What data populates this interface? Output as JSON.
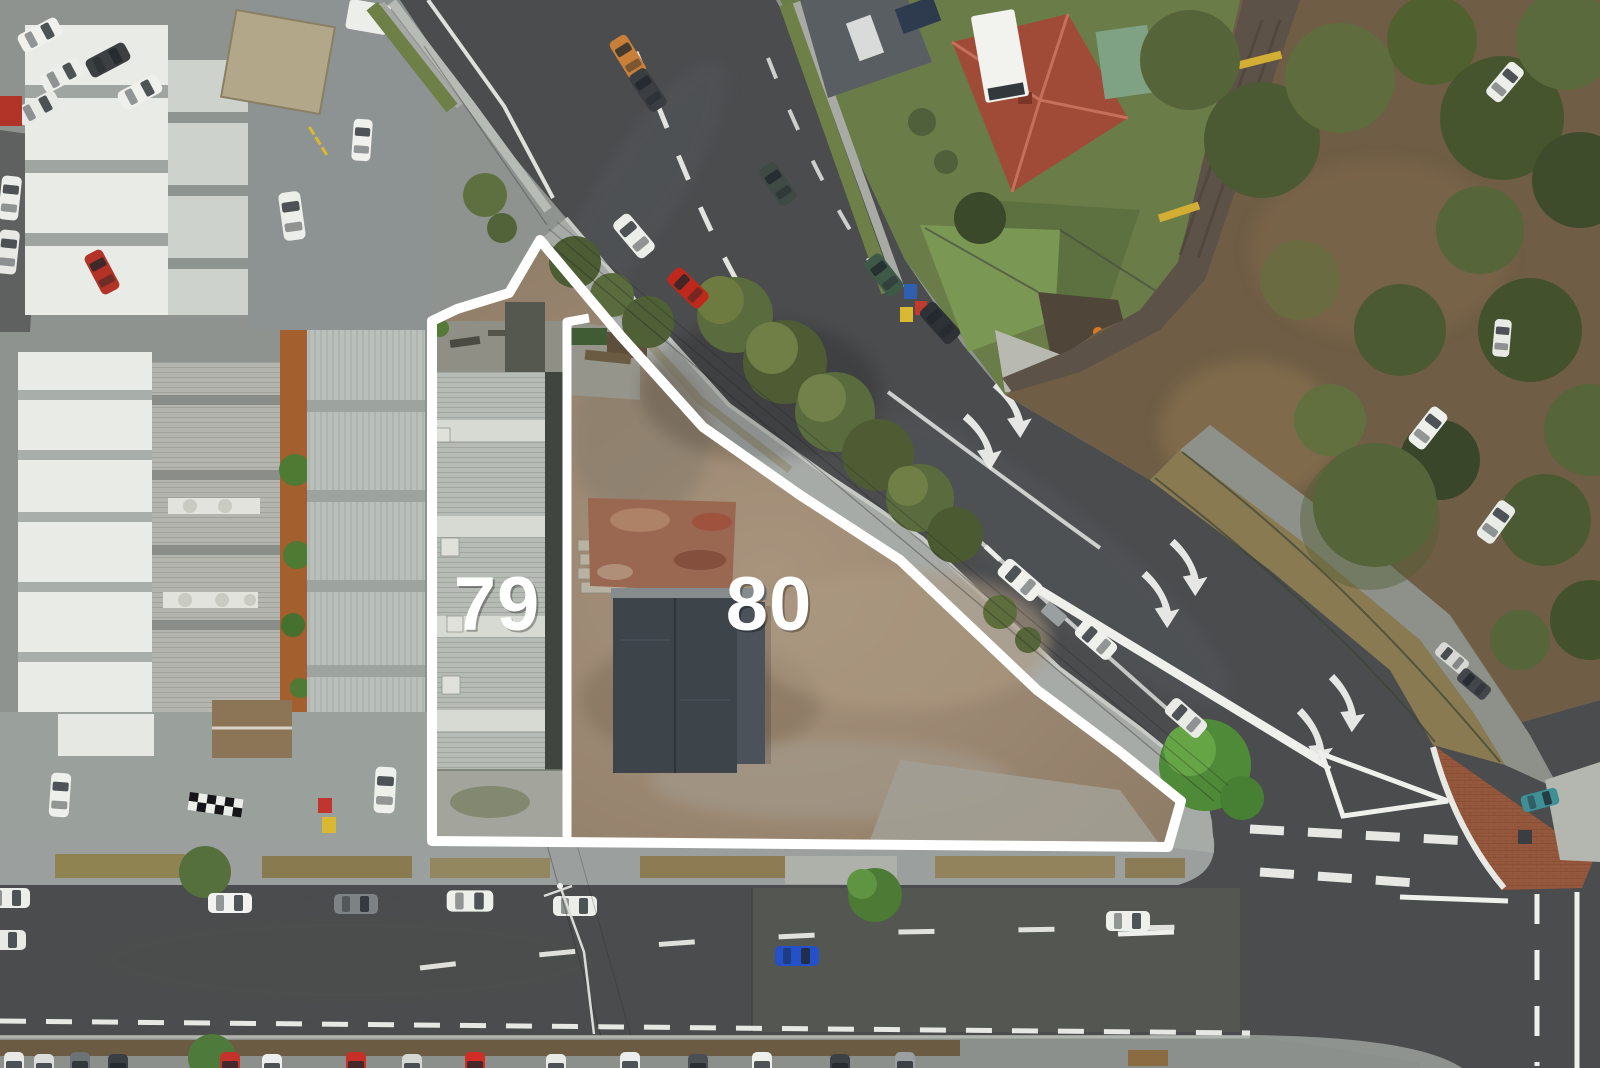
{
  "scene": {
    "description": "Aerial drone photograph of a triangular corner development site outlined in white, split into two lots beside a curving main road, industrial warehouses, houses and bushland",
    "overlay": {
      "boundary_color": "#ffffff",
      "lots": [
        {
          "id": "lot-79",
          "label": "79"
        },
        {
          "id": "lot-80",
          "label": "80"
        }
      ]
    },
    "palette": {
      "label_text": "#ffffff",
      "asphalt": "#4a4c4e",
      "asphalt_light": "#565854",
      "road_marking": "#eff0ec",
      "sidewalk": "#9ba09e",
      "site_dirt": "#9a8772",
      "shed_roof": "#3d444a",
      "warehouse_white": "#e9ebe6",
      "lot79_roof": "#b6bbb6",
      "bush_ground": "#6f5d45",
      "tree_green": "#55643a",
      "lawn_green": "#6a7d48",
      "house_roof_red": "#a04a38",
      "brick_island": "#96583c"
    }
  }
}
